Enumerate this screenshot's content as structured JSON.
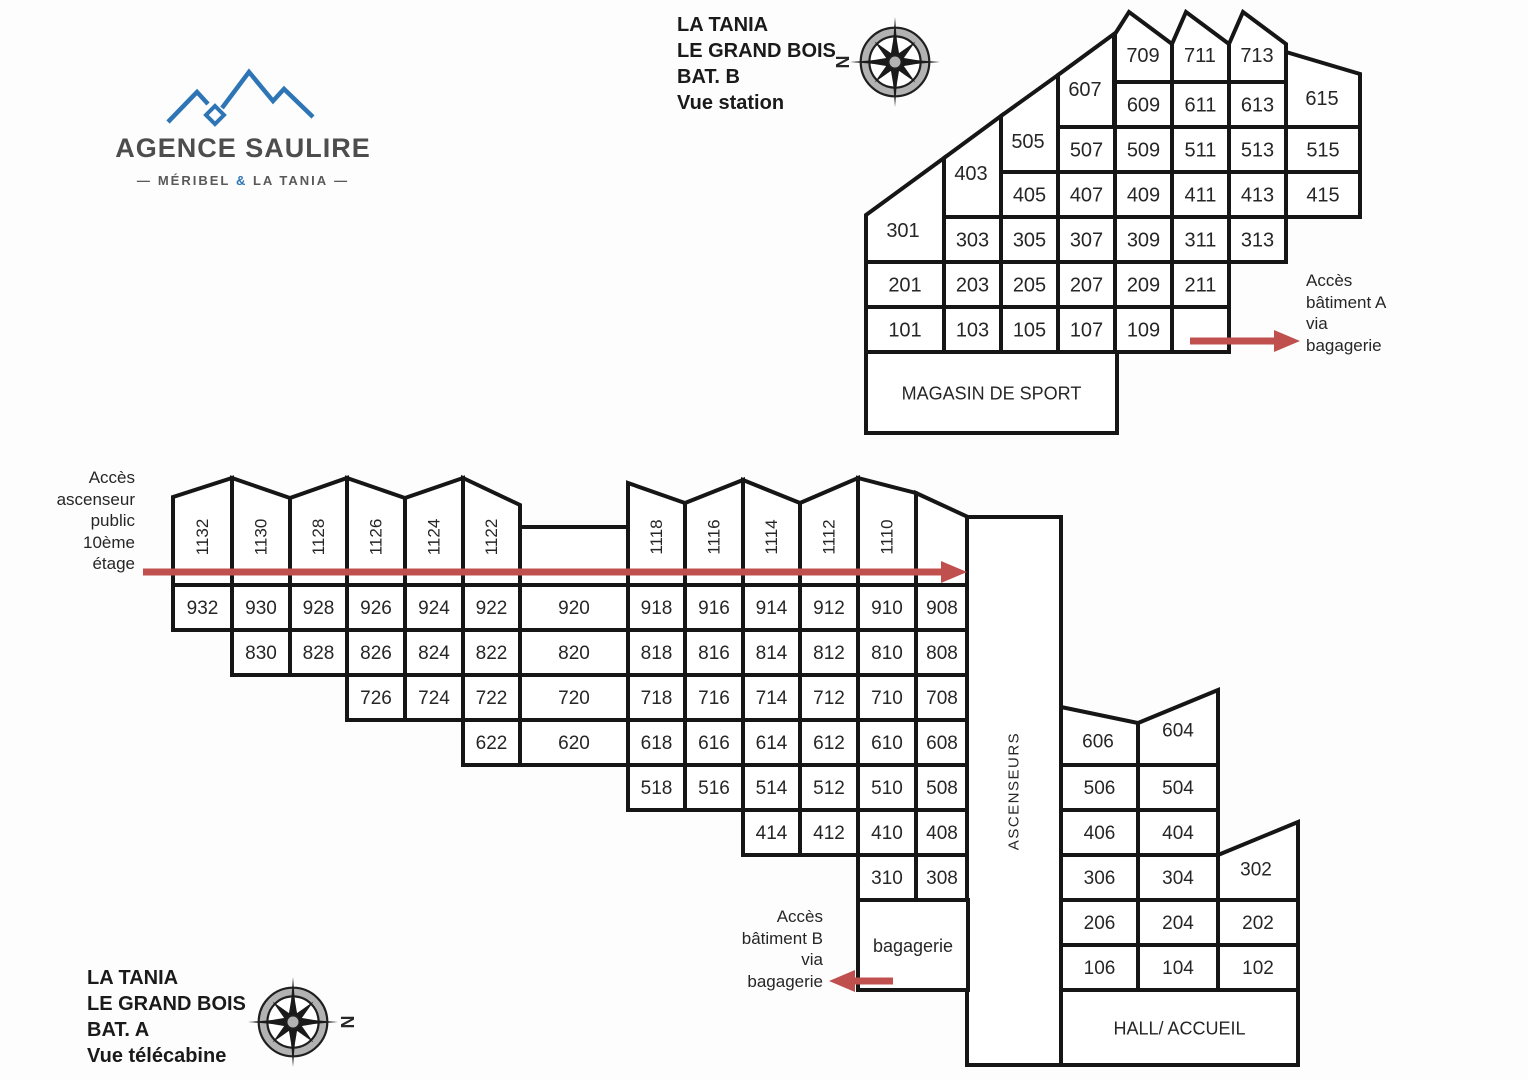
{
  "agency": {
    "name": "AGENCE SAULIRE",
    "tagline_left": "MÉRIBEL",
    "tagline_amp": "&",
    "tagline_right": "LA TANIA",
    "dash": "—"
  },
  "bat_b": {
    "title_lines": [
      "LA TANIA",
      "LE GRAND BOIS",
      "BAT. B",
      "Vue station"
    ],
    "rooms": [
      "709",
      "711",
      "713",
      "607",
      "609",
      "611",
      "613",
      "615",
      "505",
      "507",
      "509",
      "511",
      "513",
      "515",
      "403",
      "405",
      "407",
      "409",
      "411",
      "413",
      "415",
      "301",
      "303",
      "305",
      "307",
      "309",
      "311",
      "313",
      "201",
      "203",
      "205",
      "207",
      "209",
      "211",
      "101",
      "103",
      "105",
      "107",
      "109"
    ],
    "shop": "MAGASIN DE SPORT",
    "access_note_lines": [
      "Accès",
      "bâtiment A",
      "via",
      "bagagerie"
    ]
  },
  "bat_a": {
    "title_lines": [
      "LA TANIA",
      "LE GRAND BOIS",
      "BAT. A",
      "Vue télécabine"
    ],
    "rooms": [
      "1132",
      "1130",
      "1128",
      "1126",
      "1124",
      "1122",
      "1118",
      "1116",
      "1114",
      "1112",
      "1110",
      "932",
      "930",
      "928",
      "926",
      "924",
      "922",
      "920",
      "918",
      "916",
      "914",
      "912",
      "910",
      "908",
      "830",
      "828",
      "826",
      "824",
      "822",
      "820",
      "818",
      "816",
      "814",
      "812",
      "810",
      "808",
      "726",
      "724",
      "722",
      "720",
      "718",
      "716",
      "714",
      "712",
      "710",
      "708",
      "622",
      "620",
      "618",
      "616",
      "614",
      "612",
      "610",
      "608",
      "518",
      "516",
      "514",
      "512",
      "510",
      "508",
      "414",
      "412",
      "410",
      "408",
      "310",
      "308",
      "606",
      "604",
      "506",
      "504",
      "406",
      "404",
      "306",
      "304",
      "302",
      "206",
      "204",
      "202",
      "106",
      "104",
      "102"
    ],
    "ascenseurs": "ASCENSEURS",
    "bagagerie": "bagagerie",
    "hall": "HALL/ ACCUEIL",
    "elevator_note_lines": [
      "Accès",
      "ascenseur",
      "public",
      "10ème",
      "étage"
    ],
    "access_note_lines": [
      "Accès",
      "bâtiment B",
      "via",
      "bagagerie"
    ]
  },
  "compass": {
    "letter": "N"
  },
  "colors": {
    "red": "#c0504d",
    "blue": "#2e75b6",
    "line": "#161616"
  }
}
